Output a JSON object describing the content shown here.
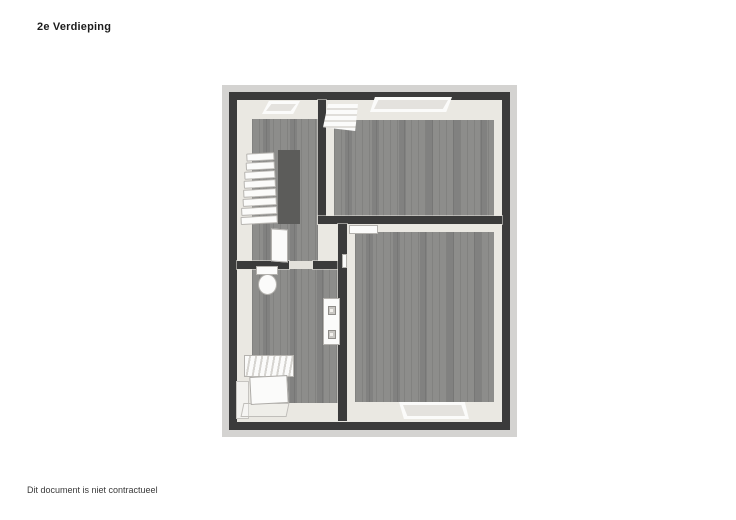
{
  "page": {
    "title": "2e Verdieping",
    "footer": "Dit document is niet contractueel"
  },
  "floorplan": {
    "type": "floor-plan-3d-top-view",
    "floor_label": "2e Verdieping",
    "staircase_steps": 8,
    "rooms": [
      {
        "name": "landing-with-staircase",
        "position": "top-left"
      },
      {
        "name": "bedroom",
        "position": "top-right"
      },
      {
        "name": "bathroom",
        "position": "bottom-left"
      },
      {
        "name": "bedroom",
        "position": "bottom-right"
      }
    ],
    "fixtures": [
      "staircase",
      "stairwell-void",
      "skylight-hall",
      "roof-window",
      "skylight-top",
      "skylight-bottom",
      "open-door",
      "door-panel",
      "toilet",
      "socket-panel",
      "cabinet"
    ],
    "colors": {
      "page_bg": "#ffffff",
      "platform": "#d4d3d1",
      "wall": "#3b3b3b",
      "interior": "#eae8e2",
      "floor": "#8d8d8b",
      "floor_streak": "#818180",
      "stair_void": "#5c5c5a",
      "fixture": "#fbfbfa",
      "fixture_outline": "#b3b1ad"
    }
  }
}
